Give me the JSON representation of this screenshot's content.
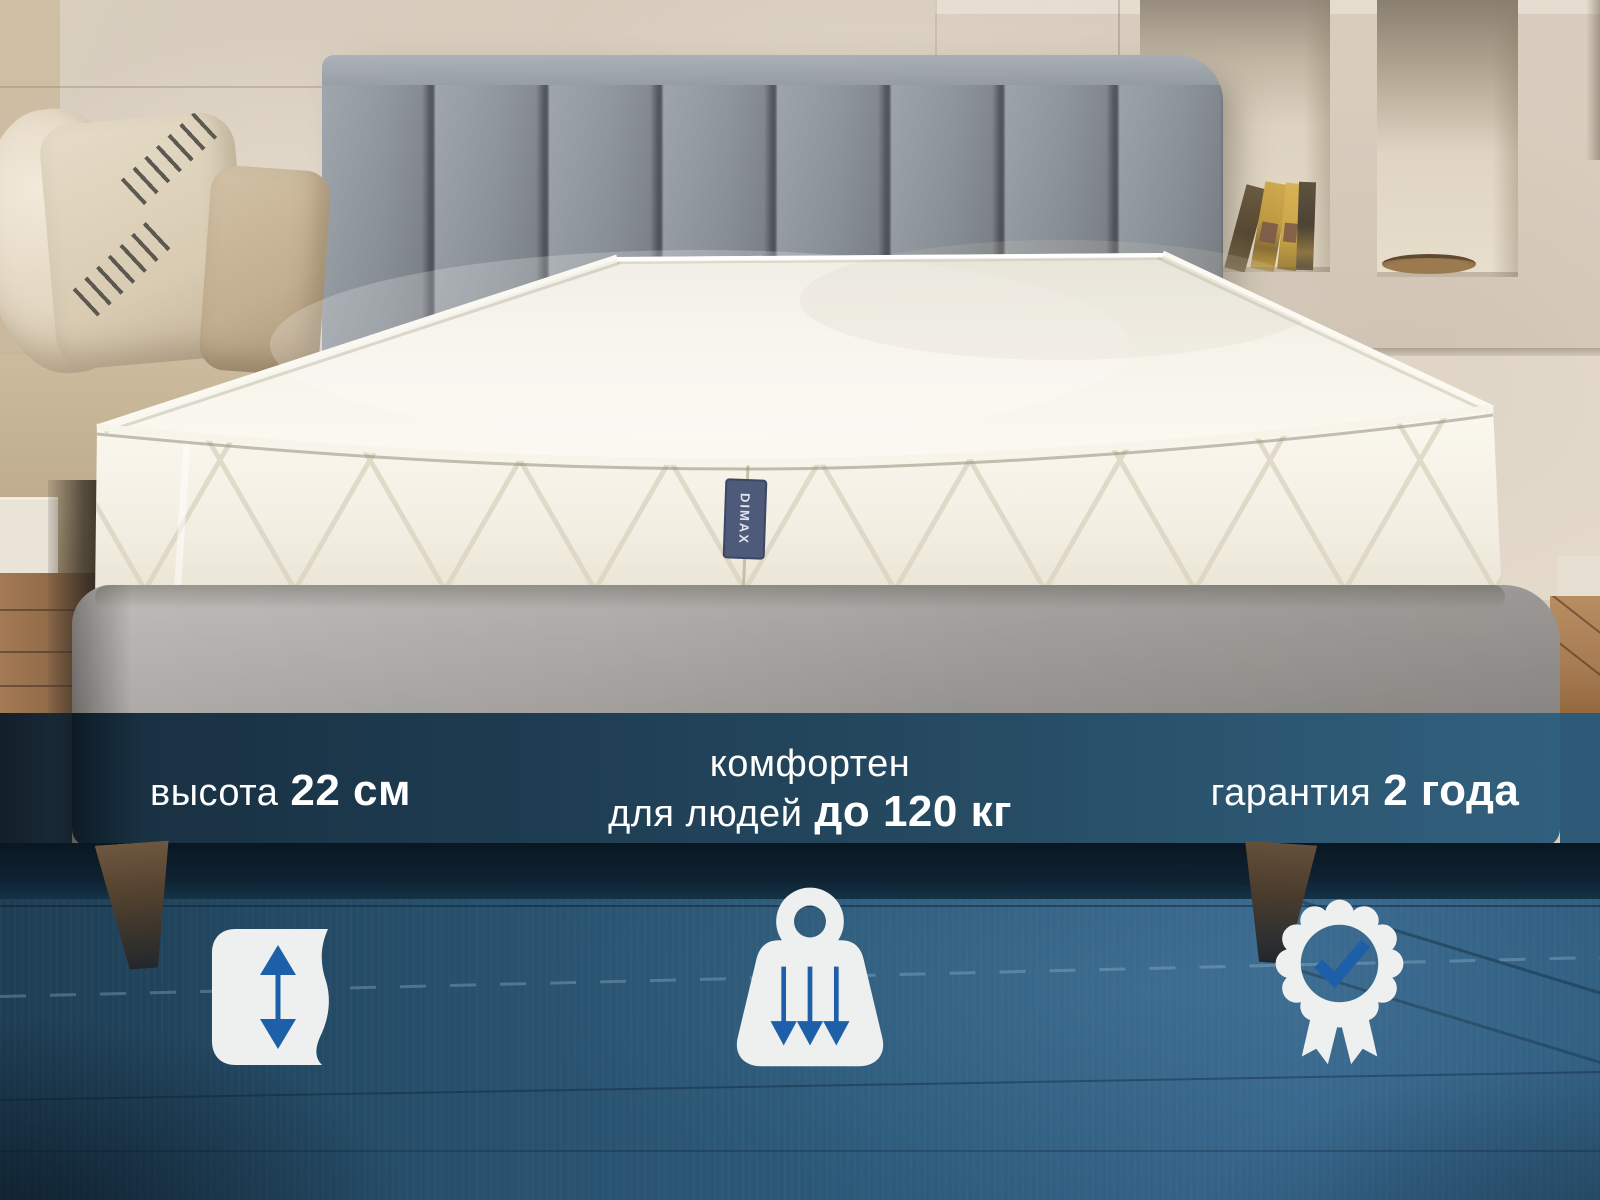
{
  "banner": {
    "features": [
      {
        "id": "height",
        "icon": "mattress-height-icon",
        "text_regular": "высота",
        "text_bold": "22 см"
      },
      {
        "id": "weight-capacity",
        "icon": "weight-icon",
        "line1": "комфортен",
        "line2_regular": "для людей",
        "line2_bold": "до 120 кг"
      },
      {
        "id": "warranty",
        "icon": "award-badge-icon",
        "text_regular": "гарантия",
        "text_bold": "2 года"
      }
    ],
    "text_color": "#ffffff",
    "accent_blue": "#1d5fa8",
    "icon_white": "#eef0f0",
    "overlay_navy": "#1e4058"
  },
  "mattress_tag": {
    "brand": "DIMAX",
    "tag_color": "#4e5a7a"
  }
}
